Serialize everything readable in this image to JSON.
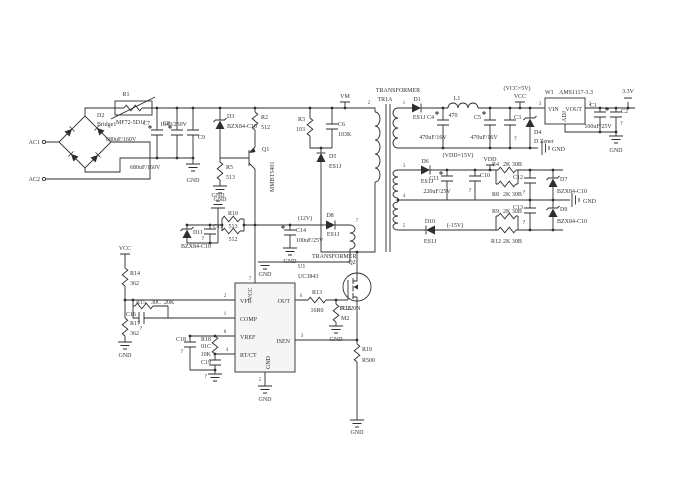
{
  "colors": {
    "ink": "#2e2e2e",
    "background": "#ffffff",
    "ic_fill": "#f5f5f5"
  },
  "nets": {
    "ac1": "AC1",
    "ac2": "AC2",
    "vm": "VM",
    "vcc": "VCC",
    "vcc_5v": "(VCC=5V)",
    "vdd": "VDD",
    "vdd_15v": "(VDD=15V)",
    "neg_15v": "(-15V)",
    "v12": "(12V)",
    "v3_3": "3.3V",
    "gnd": "GND"
  },
  "transformer": {
    "label": "TRANSFORMER",
    "name": "TR1A",
    "pins": {
      "pri_top": "2",
      "sec1_top": "1",
      "sec2_top": "3",
      "center": "4",
      "sec3_bot": "5",
      "aux_top": "7"
    }
  },
  "parts": {
    "r1": {
      "ref": "R1",
      "value": "MF72-5D11"
    },
    "r2": {
      "ref": "R2",
      "value": "512"
    },
    "r3": {
      "ref": "R3",
      "value": "103"
    },
    "r4": {
      "ref": "R4",
      "value": "2K 30B"
    },
    "r5": {
      "ref": "R5",
      "value": "513"
    },
    "r8": {
      "ref": "R8",
      "value": "2K 30B"
    },
    "r9": {
      "ref": "R9",
      "value": "2K 30B"
    },
    "r10": {
      "ref": "R10",
      "value": "513"
    },
    "r11": {
      "value": "512"
    },
    "r12": {
      "ref": "R12",
      "value": "2K 30B"
    },
    "r13": {
      "ref": "R13",
      "value": "16R0"
    },
    "r14": {
      "ref": "R14",
      "value": "362"
    },
    "r15": {
      "ref": "R15",
      "code": "30C",
      "value": "20K"
    },
    "r16": {
      "ref": "R16",
      "value": "M2"
    },
    "r17": {
      "ref": "R17",
      "value": "362"
    },
    "r18": {
      "ref": "R18",
      "code": "01C",
      "value": "10K"
    },
    "r19": {
      "ref": "R19",
      "value": "R500"
    },
    "c1": {
      "ref": "C1",
      "value": "100uF/25V"
    },
    "c2": {
      "ref": "C2",
      "value": "?"
    },
    "c3": {
      "ref": "C3",
      "value": "?"
    },
    "c4": {
      "ref": "C4",
      "value": "470uF/16V"
    },
    "c5": {
      "ref": "C5",
      "value": "470uF/16V"
    },
    "c6": {
      "ref": "C6",
      "value": "103K"
    },
    "c7": {
      "ref": "C7",
      "value": "680uF/160V"
    },
    "c8": {
      "ref": "C8",
      "value": "680uF/160V"
    },
    "c9": {
      "ref": "C9",
      "value": "1043/250V"
    },
    "c10": {
      "ref": "C10",
      "value": "?"
    },
    "c11": {
      "ref": "C11",
      "value": "220uF/25V"
    },
    "c12": {
      "ref": "C12",
      "value": "?"
    },
    "c13": {
      "ref": "C13",
      "value": "?"
    },
    "c14": {
      "ref": "C14",
      "value": "100uF/25V"
    },
    "c15": {
      "ref": "C15",
      "value": "?"
    },
    "c16": {
      "ref": "C16",
      "value": "?"
    },
    "c18": {
      "ref": "C18",
      "value": "?"
    },
    "c19": {
      "ref": "C19",
      "value": "?"
    },
    "d1": {
      "ref": "D1",
      "value": "ES1J"
    },
    "d2": {
      "ref": "D2",
      "value": "Bridge1"
    },
    "d3": {
      "ref": "D3",
      "value": "BZX84-C10"
    },
    "d4": {
      "ref": "D4",
      "value": "D Zener"
    },
    "d5": {
      "ref": "D5",
      "value": "ES1J"
    },
    "d6": {
      "ref": "D6",
      "value": "ES1J"
    },
    "d7": {
      "ref": "D7",
      "value": "BZX84-C10"
    },
    "d8": {
      "ref": "D8",
      "value": "ES1J"
    },
    "d9": {
      "ref": "D9",
      "value": "BZX84-C10"
    },
    "d10": {
      "ref": "D10",
      "value": "ES1J"
    },
    "d11": {
      "ref": "D11",
      "value": "BZX84-C10"
    },
    "l1": {
      "ref": "L1",
      "value": "470"
    },
    "q1": {
      "ref": "Q1",
      "value": "MMBT5401"
    },
    "q2": {
      "ref": "Q2",
      "value": "FU220N"
    },
    "u1": {
      "ref": "U1",
      "value": "UC3843",
      "pins": {
        "vfb": "VFB",
        "comp": "COMP",
        "vref": "VREF",
        "rtct": "RT/CT",
        "out": "OUT",
        "isen": "ISEN",
        "vcc": "VCC",
        "gnd": "GND"
      },
      "pin_numbers": {
        "vfb": "2",
        "comp": "1",
        "vref": "8",
        "rtct": "4",
        "out": "6",
        "isen": "3",
        "vcc": "7",
        "gnd": "5"
      }
    },
    "w1": {
      "ref": "W1",
      "value": "AMS1117-3.3",
      "pins": {
        "vin": "VIN",
        "vout": "VOUT",
        "adj": "ADJ"
      },
      "pin_numbers": {
        "vin": "3",
        "vout": "2"
      }
    }
  }
}
